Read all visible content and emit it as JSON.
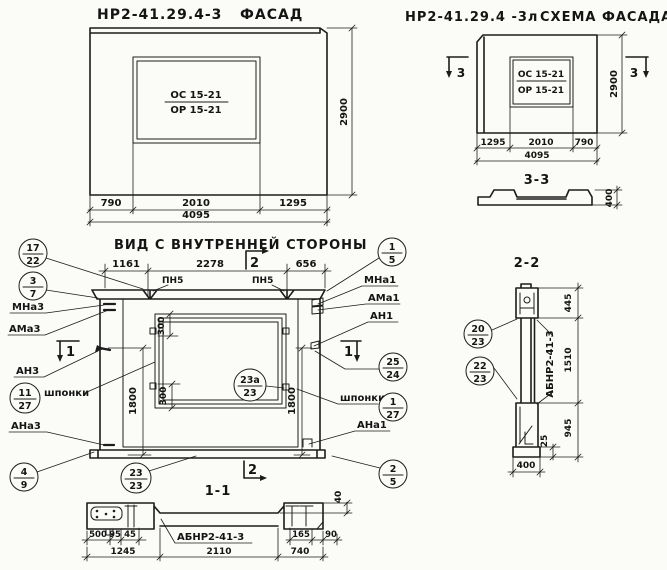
{
  "facade": {
    "code": "НР2-41.29.4-3",
    "title": "ФАСАД",
    "window_mark_top": "ОС 15-21",
    "window_mark_bottom": "ОР 15-21",
    "dims": {
      "left": "790",
      "mid": "2010",
      "right": "1295",
      "total": "4095",
      "height": "2900"
    }
  },
  "schema": {
    "code": "НР2-41.29.4 -3л",
    "title": "СХЕМА ФАСАДА",
    "window_mark_top": "ОС 15-21",
    "window_mark_bottom": "ОР 15-21",
    "section_marker": "3",
    "dims": {
      "left": "1295",
      "mid": "2010",
      "right": "790",
      "total": "4095",
      "height": "2900"
    }
  },
  "section33": {
    "title": "3-3",
    "thickness": "400"
  },
  "inner": {
    "title": "ВИД С ВНУТРЕННЕЙ СТОРОНЫ",
    "pn5_1": "ПН5",
    "pn5_2": "ПН5",
    "marker_1": "1",
    "marker_2": "2",
    "dims": {
      "top_left": "1161",
      "top_mid": "2278",
      "top_right": "656",
      "side_left": "1800",
      "side_right": "1800",
      "win_top": "300",
      "win_bottom": "300"
    },
    "left_labels": {
      "mna": "МНа3",
      "ama": "АМа3",
      "an": "АН3",
      "shponki": "шпонки",
      "ana": "АНа3"
    },
    "right_labels": {
      "mna": "МНа1",
      "ama": "АМа1",
      "an": "АН1",
      "shponki": "шпонки",
      "ana": "АНа1"
    }
  },
  "section11": {
    "title": "1-1",
    "beam_label": "АБНР2-41-3",
    "dims": {
      "d500": "500",
      "d95": "95",
      "d45": "45",
      "d1245": "1245",
      "d2110": "2110",
      "d165": "165",
      "d90": "90",
      "d740": "740",
      "d40": "40"
    }
  },
  "section22": {
    "title": "2-2",
    "beam_label": "АБНР2-41-3",
    "dims": {
      "top": "445",
      "mid": "1510",
      "bottom": "945",
      "small": "25",
      "width": "400"
    }
  },
  "callouts": [
    {
      "top": "17",
      "bottom": "22"
    },
    {
      "top": "3",
      "bottom": "7"
    },
    {
      "top": "11",
      "bottom": "27"
    },
    {
      "top": "4",
      "bottom": "9"
    },
    {
      "top": "23",
      "bottom": "23"
    },
    {
      "top": "23а",
      "bottom": "23"
    },
    {
      "top": "1",
      "bottom": "5"
    },
    {
      "top": "25",
      "bottom": "24"
    },
    {
      "top": "1",
      "bottom": "27"
    },
    {
      "top": "2",
      "bottom": "5"
    },
    {
      "top": "20",
      "bottom": "23"
    },
    {
      "top": "22",
      "bottom": "23"
    }
  ],
  "ink_color": "#1c1c1c",
  "paper_color": "#fbfbf7"
}
